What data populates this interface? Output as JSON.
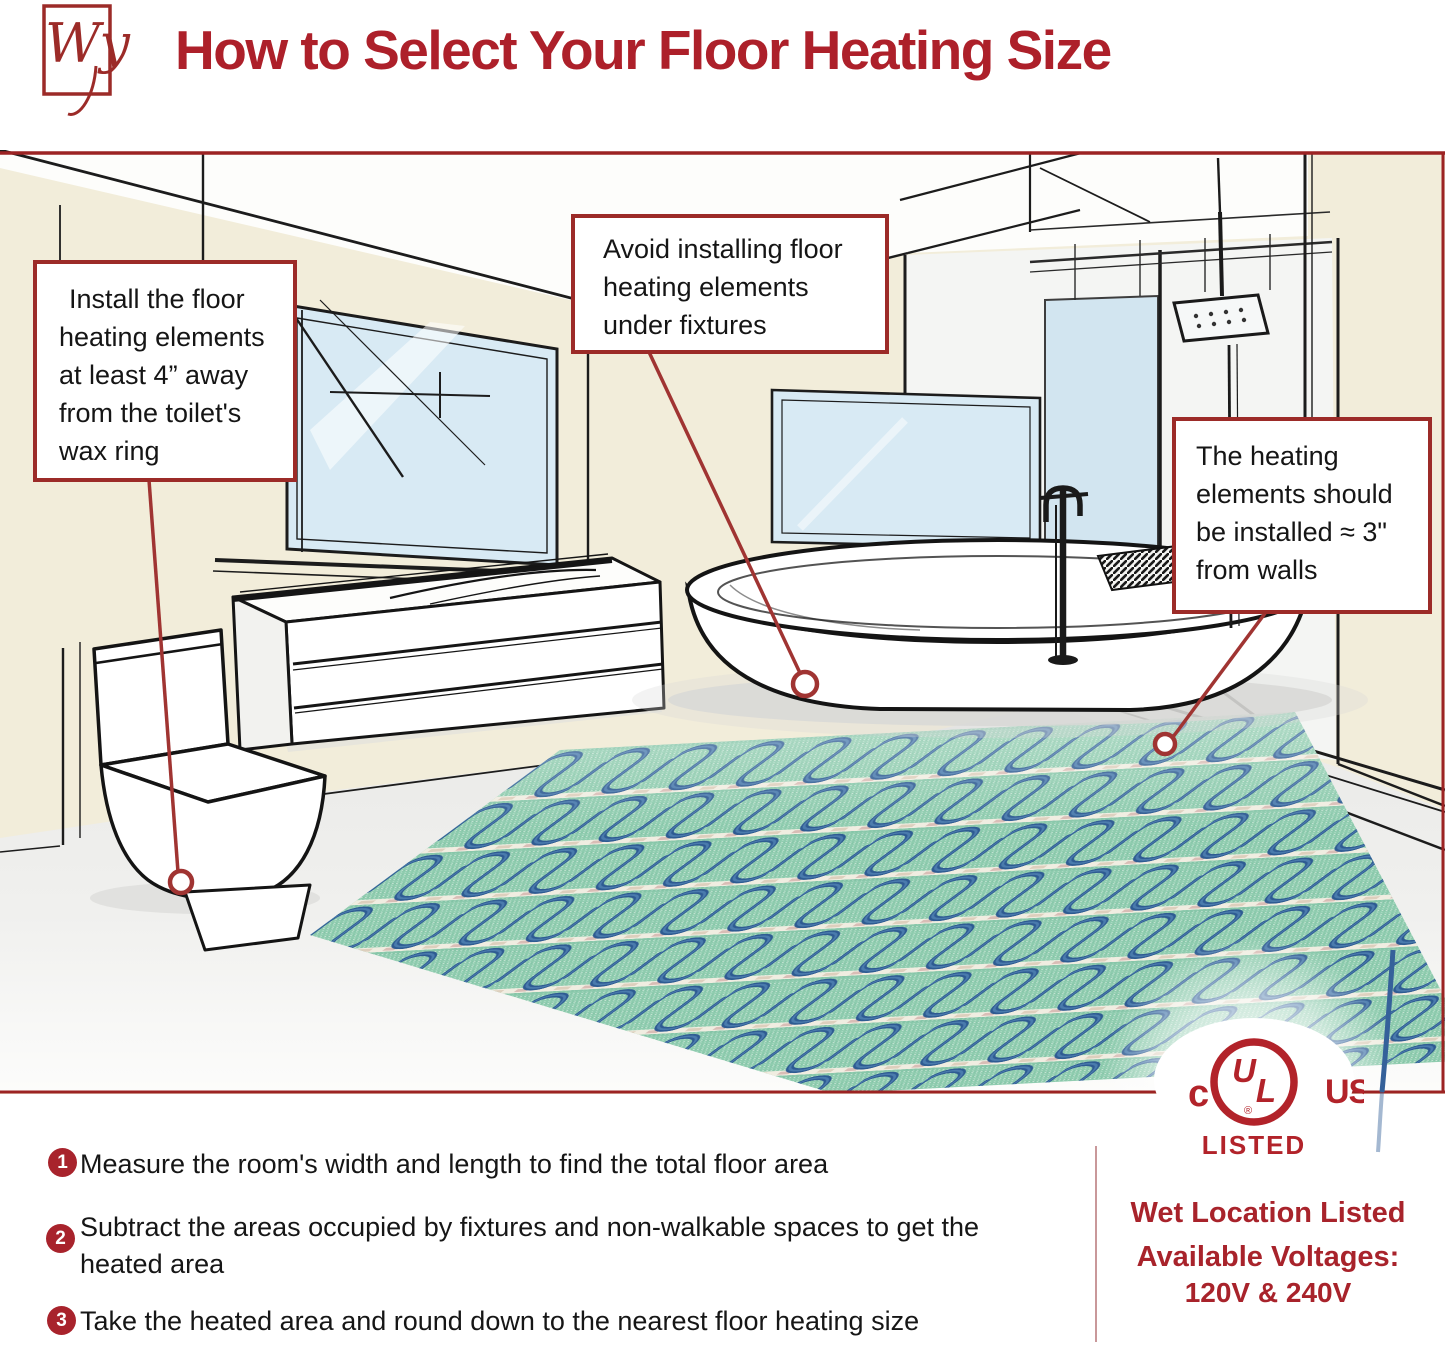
{
  "page": {
    "logo_text": "Wy",
    "title": "How to Select Your Floor Heating Size"
  },
  "callouts": {
    "toilet": {
      "lines": [
        "Install the floor",
        "heating elements",
        "at least 4” away",
        "from the toilet's",
        "wax ring"
      ]
    },
    "fixtures": {
      "lines": [
        "Avoid installing floor",
        "heating elements",
        "under fixtures"
      ]
    },
    "walls": {
      "lines": [
        "The heating",
        "elements should",
        "be installed ≈ 3\"",
        "from walls"
      ]
    }
  },
  "steps": [
    {
      "num": "1",
      "text": "Measure the room's width and length to find the total floor area"
    },
    {
      "num": "2",
      "text": "Subtract the areas occupied by fixtures and non-walkable spaces to get the heated area"
    },
    {
      "num": "3",
      "text": "Take the heated area and round down to the nearest floor heating size"
    }
  ],
  "certification": {
    "c": "c",
    "u": "U",
    "l": "L",
    "us": "US",
    "reg": "®",
    "listed": "LISTED",
    "wet_location": "Wet Location Listed",
    "voltages_label": "Available Voltages:",
    "voltages_value": "120V & 240V"
  },
  "colors": {
    "accent_red": "#9c2b28",
    "title_red": "#ad202a",
    "ul_red": "#b2232a",
    "text": "#1a1a1a",
    "wall_cream": "#f2edda",
    "window_blue": "#d8eaf4",
    "mat_green": "#8ecbae",
    "cable_blue": "#2e5b92",
    "tape_white": "#f0ede1"
  }
}
